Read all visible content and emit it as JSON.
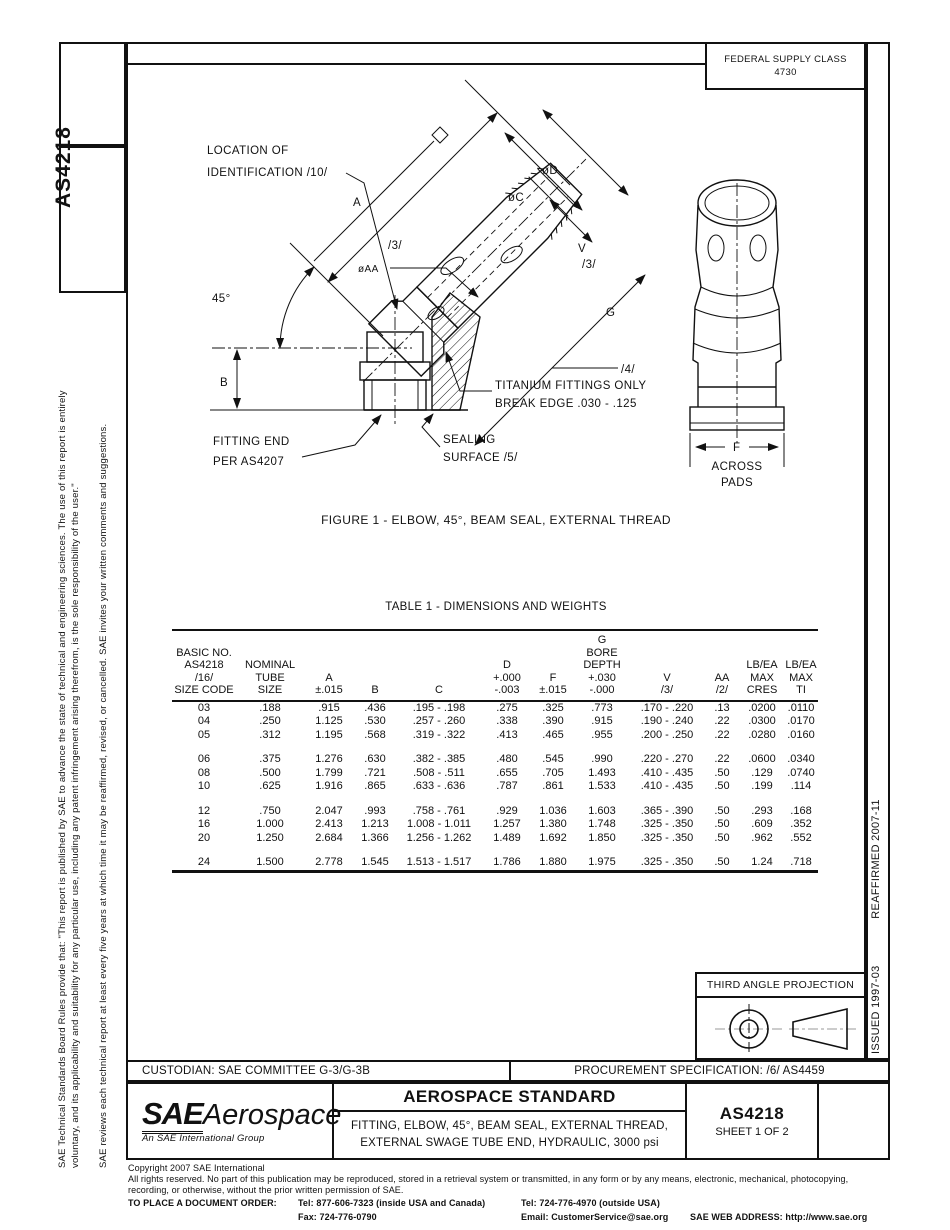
{
  "header": {
    "fsc_line1": "FEDERAL SUPPLY CLASS",
    "fsc_line2": "4730"
  },
  "left_margin": {
    "doc_number": "AS4218",
    "disclaimer_line1": "SAE Technical Standards Board Rules provide that: \"This report is published by SAE to advance the state of technical and engineering sciences. The use of this report is entirely",
    "disclaimer_line2": "voluntary, and its applicability and suitability for any particular use, including any patent infringement arising therefrom, is the sole responsibility of the user.\"",
    "review_note": "SAE reviews each technical report at least every five years at which time it may be reaffirmed, revised, or cancelled. SAE invites your written comments and suggestions."
  },
  "right_margin": {
    "issued": "ISSUED 1997-03",
    "reaffirmed": "REAFFIRMED 2007-11"
  },
  "figure": {
    "caption": "FIGURE 1 - ELBOW, 45°, BEAM SEAL, EXTERNAL THREAD",
    "labels": {
      "location_line1": "LOCATION OF",
      "location_line2": "IDENTIFICATION /10/",
      "dim_a": "A",
      "flag_3a": "/3/",
      "dia_aa": "øAA",
      "dia_d": "øD",
      "dia_c": "øC",
      "dim_v": "V",
      "flag_3b": "/3/",
      "angle_45": "45°",
      "dim_b": "B",
      "dim_g": "G",
      "flag_4": "/4/",
      "titanium_line1": "TITANIUM FITTINGS ONLY",
      "titanium_line2": "BREAK EDGE .030 - .125",
      "sealing_line1": "SEALING",
      "sealing_line2": "SURFACE /5/",
      "fitting_end_line1": "FITTING END",
      "fitting_end_line2": "PER AS4207",
      "dim_f": "F",
      "across_line1": "ACROSS",
      "across_line2": "PADS"
    }
  },
  "table": {
    "title": "TABLE 1 - DIMENSIONS AND WEIGHTS",
    "headers": [
      "BASIC NO.\nAS4218\n/16/\nSIZE CODE",
      "NOMINAL\nTUBE\nSIZE",
      "A\n±.015",
      "B",
      "C",
      "D\n+.000\n-.003",
      "F\n±.015",
      "G\nBORE\nDEPTH\n+.030\n-.000",
      "V\n/3/",
      "AA\n/2/",
      "LB/EA\nMAX\nCRES",
      "LB/EA\nMAX\nTI"
    ],
    "group_breaks": [
      3,
      6,
      9
    ],
    "rows": [
      [
        "03",
        ".188",
        ".915",
        ".436",
        ".195 -  .198",
        ".275",
        ".325",
        ".773",
        ".170 - .220",
        ".13",
        ".0200",
        ".0110"
      ],
      [
        "04",
        ".250",
        "1.125",
        ".530",
        ".257 -  .260",
        ".338",
        ".390",
        ".915",
        ".190 - .240",
        ".22",
        ".0300",
        ".0170"
      ],
      [
        "05",
        ".312",
        "1.195",
        ".568",
        ".319 -  .322",
        ".413",
        ".465",
        ".955",
        ".200 - .250",
        ".22",
        ".0280",
        ".0160"
      ],
      [
        "06",
        ".375",
        "1.276",
        ".630",
        ".382 -  .385",
        ".480",
        ".545",
        ".990",
        ".220 - .270",
        ".22",
        ".0600",
        ".0340"
      ],
      [
        "08",
        ".500",
        "1.799",
        ".721",
        ".508 -  .511",
        ".655",
        ".705",
        "1.493",
        ".410 - .435",
        ".50",
        ".129",
        ".0740"
      ],
      [
        "10",
        ".625",
        "1.916",
        ".865",
        ".633 -  .636",
        ".787",
        ".861",
        "1.533",
        ".410 - .435",
        ".50",
        ".199",
        ".114"
      ],
      [
        "12",
        ".750",
        "2.047",
        ".993",
        ".758 -  .761",
        ".929",
        "1.036",
        "1.603",
        ".365 - .390",
        ".50",
        ".293",
        ".168"
      ],
      [
        "16",
        "1.000",
        "2.413",
        "1.213",
        "1.008 - 1.011",
        "1.257",
        "1.380",
        "1.748",
        ".325 - .350",
        ".50",
        ".609",
        ".352"
      ],
      [
        "20",
        "1.250",
        "2.684",
        "1.366",
        "1.256 - 1.262",
        "1.489",
        "1.692",
        "1.850",
        ".325 - .350",
        ".50",
        ".962",
        ".552"
      ],
      [
        "24",
        "1.500",
        "2.778",
        "1.545",
        "1.513 - 1.517",
        "1.786",
        "1.880",
        "1.975",
        ".325 - .350",
        ".50",
        "1.24",
        ".718"
      ]
    ]
  },
  "projection_box": {
    "title": "THIRD ANGLE PROJECTION"
  },
  "footer": {
    "custodian": "CUSTODIAN: SAE COMMITTEE G-3/G-3B",
    "procurement": "PROCUREMENT SPECIFICATION: /6/ AS4459",
    "logo_sae": "SAE",
    "logo_aerospace": "Aerospace",
    "logo_tagline": "An SAE International Group",
    "standard_type": "AEROSPACE STANDARD",
    "title_line1": "FITTING, ELBOW, 45°, BEAM SEAL, EXTERNAL THREAD,",
    "title_line2": "EXTERNAL SWAGE TUBE END, HYDRAULIC, 3000 psi",
    "doc_number": "AS4218",
    "sheet": "SHEET 1 OF 2"
  },
  "copyright": {
    "line1": "Copyright 2007 SAE International",
    "line2": "All rights reserved. No part of this publication may be reproduced, stored in a retrieval system or transmitted, in any form or by any means, electronic, mechanical, photocopying,",
    "line3": "recording, or otherwise, without the prior written permission of SAE.",
    "order_label": "TO PLACE A DOCUMENT ORDER:",
    "tel_inside": "Tel: 877-606-7323 (inside USA and Canada)",
    "tel_outside": "Tel: 724-776-4970 (outside USA)",
    "fax": "Fax: 724-776-0790",
    "email": "Email:  CustomerService@sae.org",
    "web": "SAE WEB ADDRESS: http://www.sae.org"
  }
}
